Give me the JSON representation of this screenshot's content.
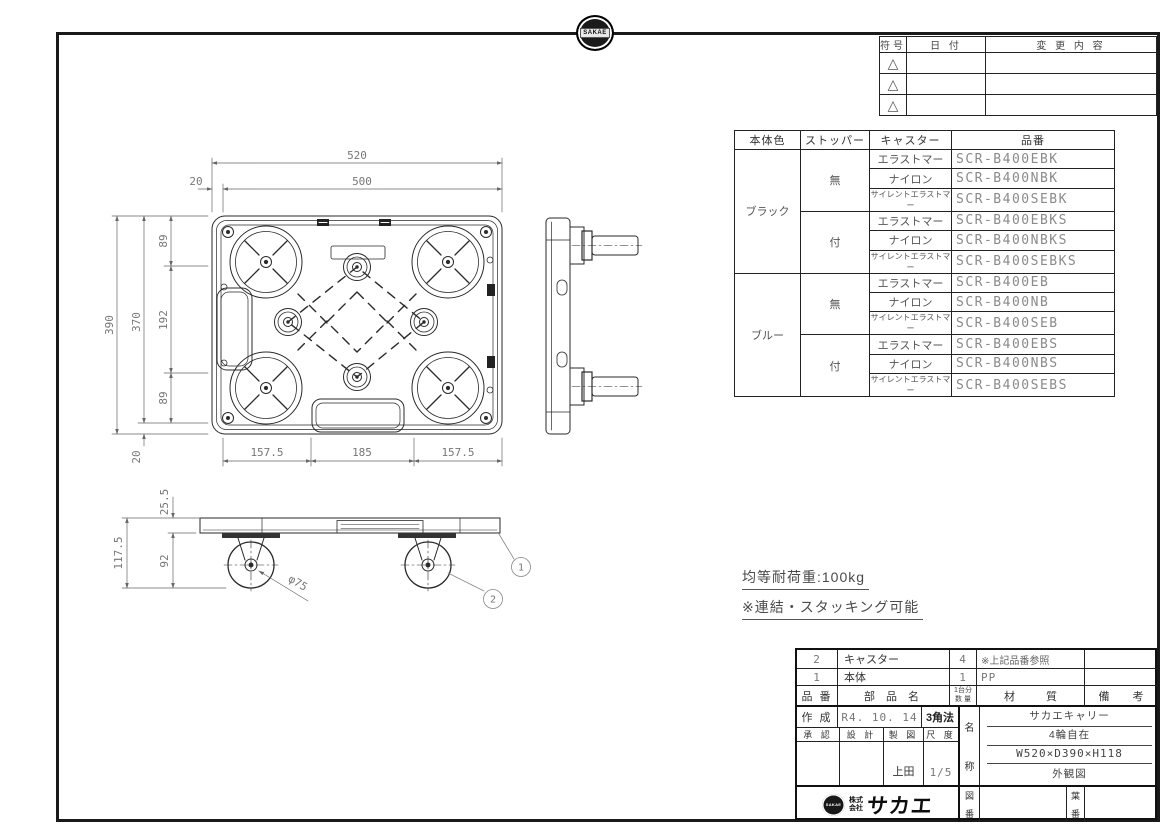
{
  "badge": {
    "text": "SAKAE"
  },
  "revision_table": {
    "headers": [
      "符号",
      "日 付",
      "変 更 内 容"
    ],
    "triangle": "△"
  },
  "parts_table": {
    "headers": [
      "本体色",
      "ストッパー",
      "キャスター",
      "品番"
    ],
    "groups": [
      {
        "color": "ブラック",
        "subs": [
          {
            "stopper": "無",
            "rows": [
              {
                "caster": "エラストマー",
                "code": "SCR-B400EBK"
              },
              {
                "caster": "ナイロン",
                "code": "SCR-B400NBK"
              },
              {
                "caster": "サイレントエラストマー",
                "code": "SCR-B400SEBK"
              }
            ]
          },
          {
            "stopper": "付",
            "rows": [
              {
                "caster": "エラストマー",
                "code": "SCR-B400EBKS"
              },
              {
                "caster": "ナイロン",
                "code": "SCR-B400NBKS"
              },
              {
                "caster": "サイレントエラストマー",
                "code": "SCR-B400SEBKS"
              }
            ]
          }
        ]
      },
      {
        "color": "ブルー",
        "subs": [
          {
            "stopper": "無",
            "rows": [
              {
                "caster": "エラストマー",
                "code": "SCR-B400EB"
              },
              {
                "caster": "ナイロン",
                "code": "SCR-B400NB"
              },
              {
                "caster": "サイレントエラストマー",
                "code": "SCR-B400SEB"
              }
            ]
          },
          {
            "stopper": "付",
            "rows": [
              {
                "caster": "エラストマー",
                "code": "SCR-B400EBS"
              },
              {
                "caster": "ナイロン",
                "code": "SCR-B400NBS"
              },
              {
                "caster": "サイレントエラストマー",
                "code": "SCR-B400SEBS"
              }
            ]
          }
        ]
      }
    ]
  },
  "notes": {
    "load": "均等耐荷重:100kg",
    "stack": "※連結・スタッキング可能"
  },
  "dims": {
    "w_total": "520",
    "w_inner": "500",
    "w_offset": "20",
    "h_total": "390",
    "h_inner": "370",
    "seg89": "89",
    "seg192": "192",
    "h_offset": "20",
    "b_side": "157.5",
    "b_mid": "185",
    "deck": "25.5",
    "total_h": "117.5",
    "caster_h": "92",
    "wheel": "φ75"
  },
  "balloons": {
    "b1": "1",
    "b2": "2"
  },
  "title_block": {
    "parts": [
      {
        "no": "2",
        "name": "キャスター",
        "qty": "4",
        "material": "※上記品番参照",
        "note": ""
      },
      {
        "no": "1",
        "name": "本体",
        "qty": "1",
        "material": "PP",
        "note": ""
      }
    ],
    "col_headers": {
      "no": "品 番",
      "name": "部 品 名",
      "qty_top": "1台分",
      "qty_bottom": "数 量",
      "material": "材 質",
      "note": "備 考"
    },
    "created_label": "作 成",
    "created": "R4. 10. 14",
    "projection": "3角法",
    "approve": "承 認",
    "design": "設 計",
    "draft": "製 図",
    "scale_label": "尺 度",
    "drafter": "上田",
    "scale": "1/5",
    "name_label_top": "名",
    "name_label_bottom": "称",
    "product": [
      "サカエキャリー",
      "4輪自在",
      "W520×D390×H118",
      "外観図"
    ],
    "company": {
      "prefix_top": "株式",
      "prefix_bottom": "会社",
      "name": "サカエ",
      "badge": "SAKAE"
    },
    "drawing_no_top": "図",
    "drawing_no_bottom": "番",
    "sheet_no_top": "葉",
    "sheet_no_bottom": "番"
  }
}
